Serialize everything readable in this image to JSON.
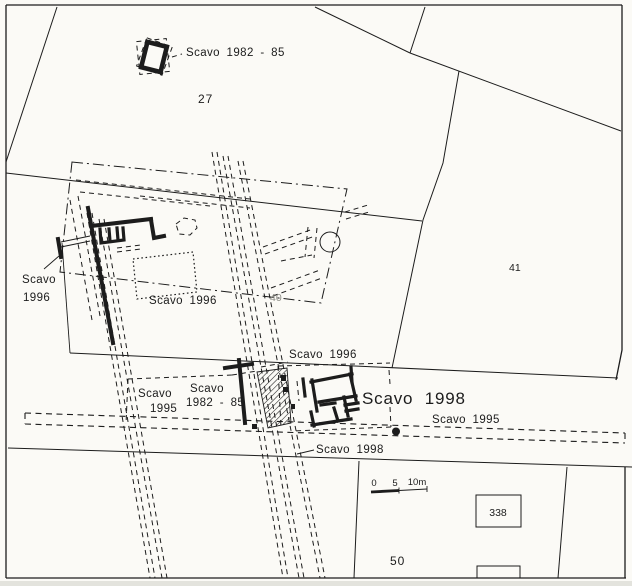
{
  "labels": {
    "excavations": {
      "top_1982_85": "Scavo 1982 - 85",
      "left_1996": {
        "line1": "Scavo",
        "line2": "1996"
      },
      "center_1996": "Scavo 1996",
      "south_1996": "Scavo 1996",
      "left_1995": {
        "line1": "Scavo",
        "line2": "1995"
      },
      "south_1982_85": {
        "line1": "Scavo",
        "line2": "1982 - 85"
      },
      "main_1998": "Scavo 1998",
      "east_1995": "Scavo 1995",
      "south_1998": "Scavo 1998"
    },
    "parcels": {
      "n27": "27",
      "n40": "40",
      "n41": "41",
      "n50": "50",
      "n338": "338"
    },
    "scale_bar": {
      "zero": "0",
      "five": "5",
      "ten": "10m"
    }
  },
  "colors": {
    "ink": "#1c1c1c",
    "paper": "#fbfaf6",
    "faint": "#8f8f88"
  }
}
